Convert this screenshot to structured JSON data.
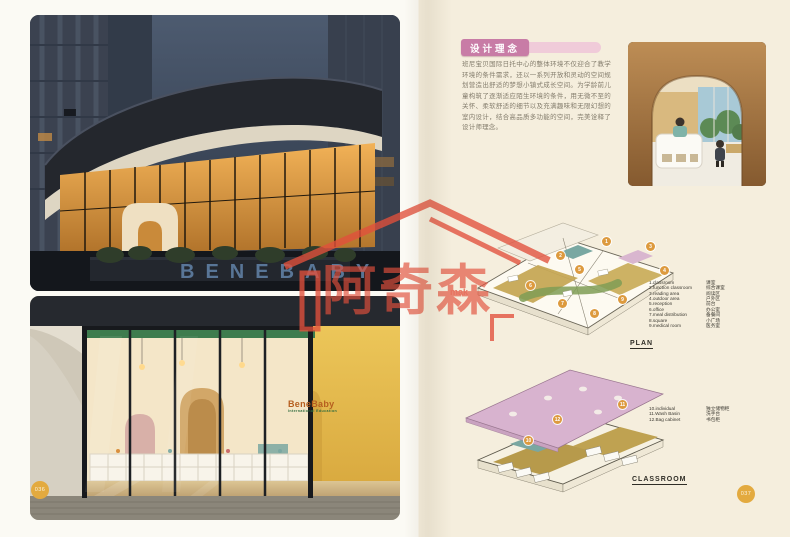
{
  "page": {
    "left_page_number": "036",
    "right_page_number": "037"
  },
  "article": {
    "section_title": "设计理念",
    "body": "班尼宝贝国际日托中心的整体环境不仅迎合了教学环境的条件需求，还以一系列开放和灵动的空间规划营造出舒适的梦想小镇式成长空间。为学龄前儿童构筑了逐渐适应陌生环境的条件，用无微不至的关怀、柔软舒适的细节以及充满趣味和无限幻想的室内设计，结合高品质多功能的空间，完美诠释了设计师理念。"
  },
  "photos": {
    "exterior_night": {
      "planter_letters": "BENEBABY"
    },
    "storefront": {
      "sign_title": "BeneBaby",
      "sign_subtitle": "International Education"
    }
  },
  "plan": {
    "label": "PLAN",
    "markers": [
      1,
      2,
      3,
      4,
      5,
      6,
      7,
      8,
      9
    ],
    "legend": [
      {
        "en": "1.classroom",
        "zh": "课室"
      },
      {
        "en": "2.function classroom",
        "zh": "综合课室"
      },
      {
        "en": "3.reading area",
        "zh": "阅读区"
      },
      {
        "en": "4.outdoor area",
        "zh": "户外区"
      },
      {
        "en": "5.reception",
        "zh": "前台"
      },
      {
        "en": "6.office",
        "zh": "办公室"
      },
      {
        "en": "7.meal distribution",
        "zh": "备餐间"
      },
      {
        "en": "8.square",
        "zh": "小广场"
      },
      {
        "en": "9.medical room",
        "zh": "医务室"
      }
    ]
  },
  "classroom": {
    "label": "CLASSROOM",
    "markers": [
      10,
      11,
      12
    ],
    "legend": [
      {
        "en": "10.individual",
        "zh": "独立储物柜"
      },
      {
        "en": "11.Wash Basin",
        "zh": "洗手台"
      },
      {
        "en": "12.Bag cabinet",
        "zh": "书包柜"
      }
    ]
  },
  "watermark": {
    "brand": "阿奇森",
    "subtext": "mak"
  },
  "colors": {
    "accent_pink": "#c87ca6",
    "accent_pink_light": "#f0cbd9",
    "marker_orange": "#dd9a3e",
    "page_circle": "#e3aa3f",
    "roof_pink": "#d8b3cf",
    "floor_khaki": "#bfa251",
    "accent_teal": "#7aa7a1",
    "plan_green": "#7f9c55",
    "watermark_red": "#e2503c",
    "right_page_bg": "#f5eedd"
  }
}
